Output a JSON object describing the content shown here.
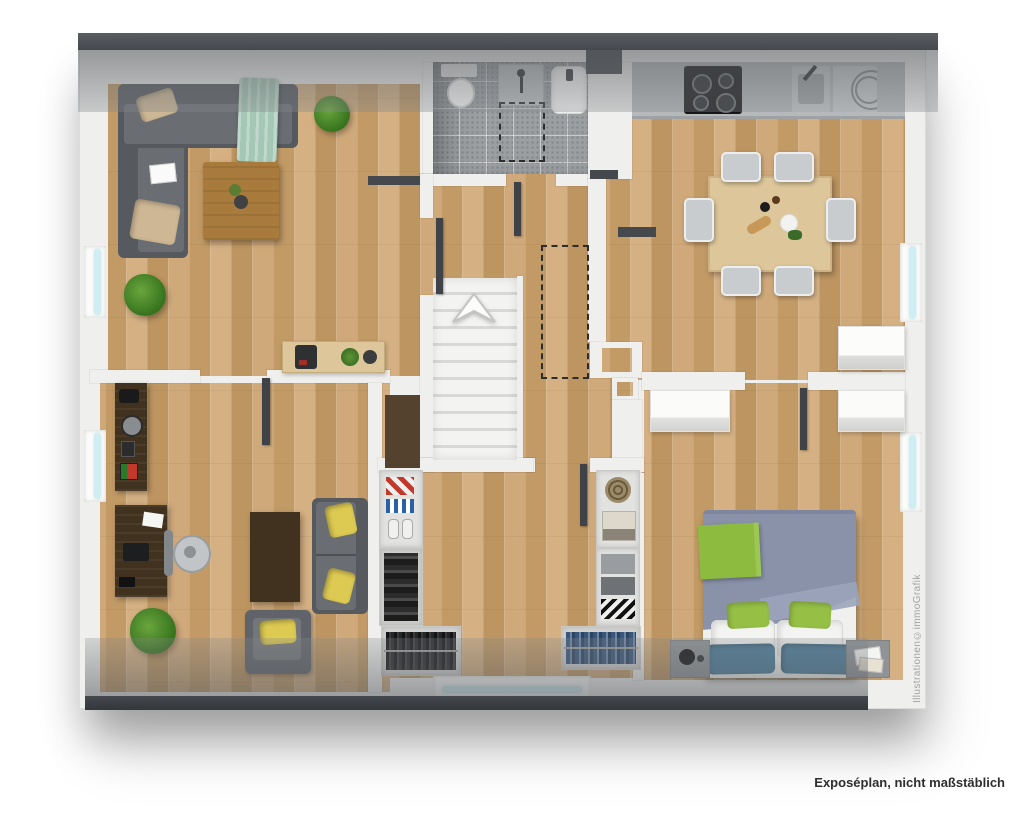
{
  "caption": "Exposéplan, nicht maßstäblich",
  "watermark": "Illustrationen©immoGrafik",
  "colors": {
    "floor_wood": "#c9a572",
    "wall": "#efefed",
    "tile": "#9b9fa2",
    "roof_edge": "#45484c",
    "door_leaf": "#3f4246",
    "window_glass": "#cfeef4",
    "stairs": "#f3f3f1",
    "counter": "#b5b9bb",
    "sofa_gray": "#565a5e",
    "pillow_beige": "#cdb794",
    "throw_green": "#a5c8b6",
    "accent_yellow": "#ddca52",
    "accent_green": "#8cbb40",
    "duvet_blue": "#8a92aa",
    "pillow_teal": "#4b7c99",
    "table_wood": "#a87b3c",
    "dining_wood": "#dcc69a",
    "dark_wood": "#41321f"
  }
}
